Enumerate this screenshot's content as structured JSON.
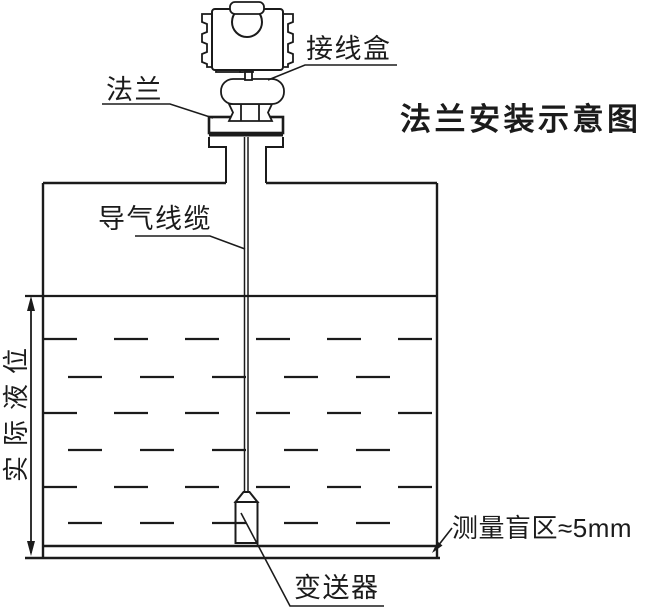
{
  "diagram": {
    "title": "法兰安装示意图",
    "labels": {
      "junction_box": "接线盒",
      "flange": "法兰",
      "air_cable": "导气线缆",
      "actual_level": "实际液位",
      "blind_zone": "测量盲区≈5mm",
      "transmitter": "变送器"
    },
    "values": {
      "blind_zone_size": "≈5mm"
    },
    "colors": {
      "line": "#1b1b1b",
      "background": "#ffffff"
    }
  }
}
